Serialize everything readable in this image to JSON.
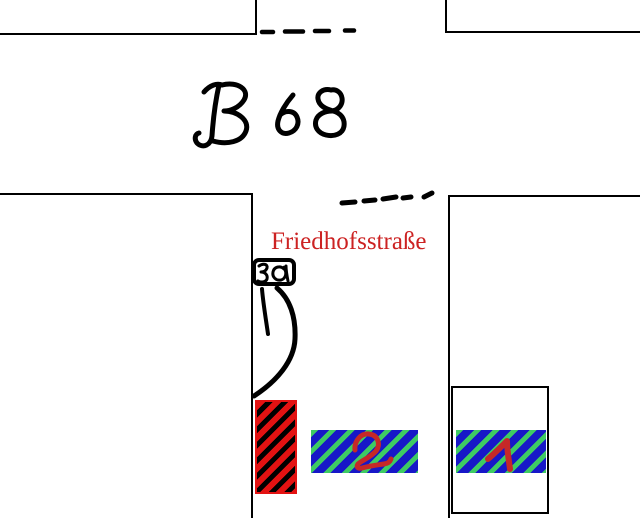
{
  "title": "Hand-drawn street sketch",
  "labels": {
    "road": "B 68",
    "street": "Friedhofsstraße",
    "speed_sign": "30",
    "area2_digit": "2",
    "area1_digit": "1"
  },
  "colors": {
    "paper": "#ffffff",
    "ink": "#000000",
    "street-red": "#cc2222",
    "stripe-red": "#e31212",
    "area-blue": "#1717c8",
    "stripe-green": "#3ecb63",
    "digit-red": "#c62828"
  }
}
